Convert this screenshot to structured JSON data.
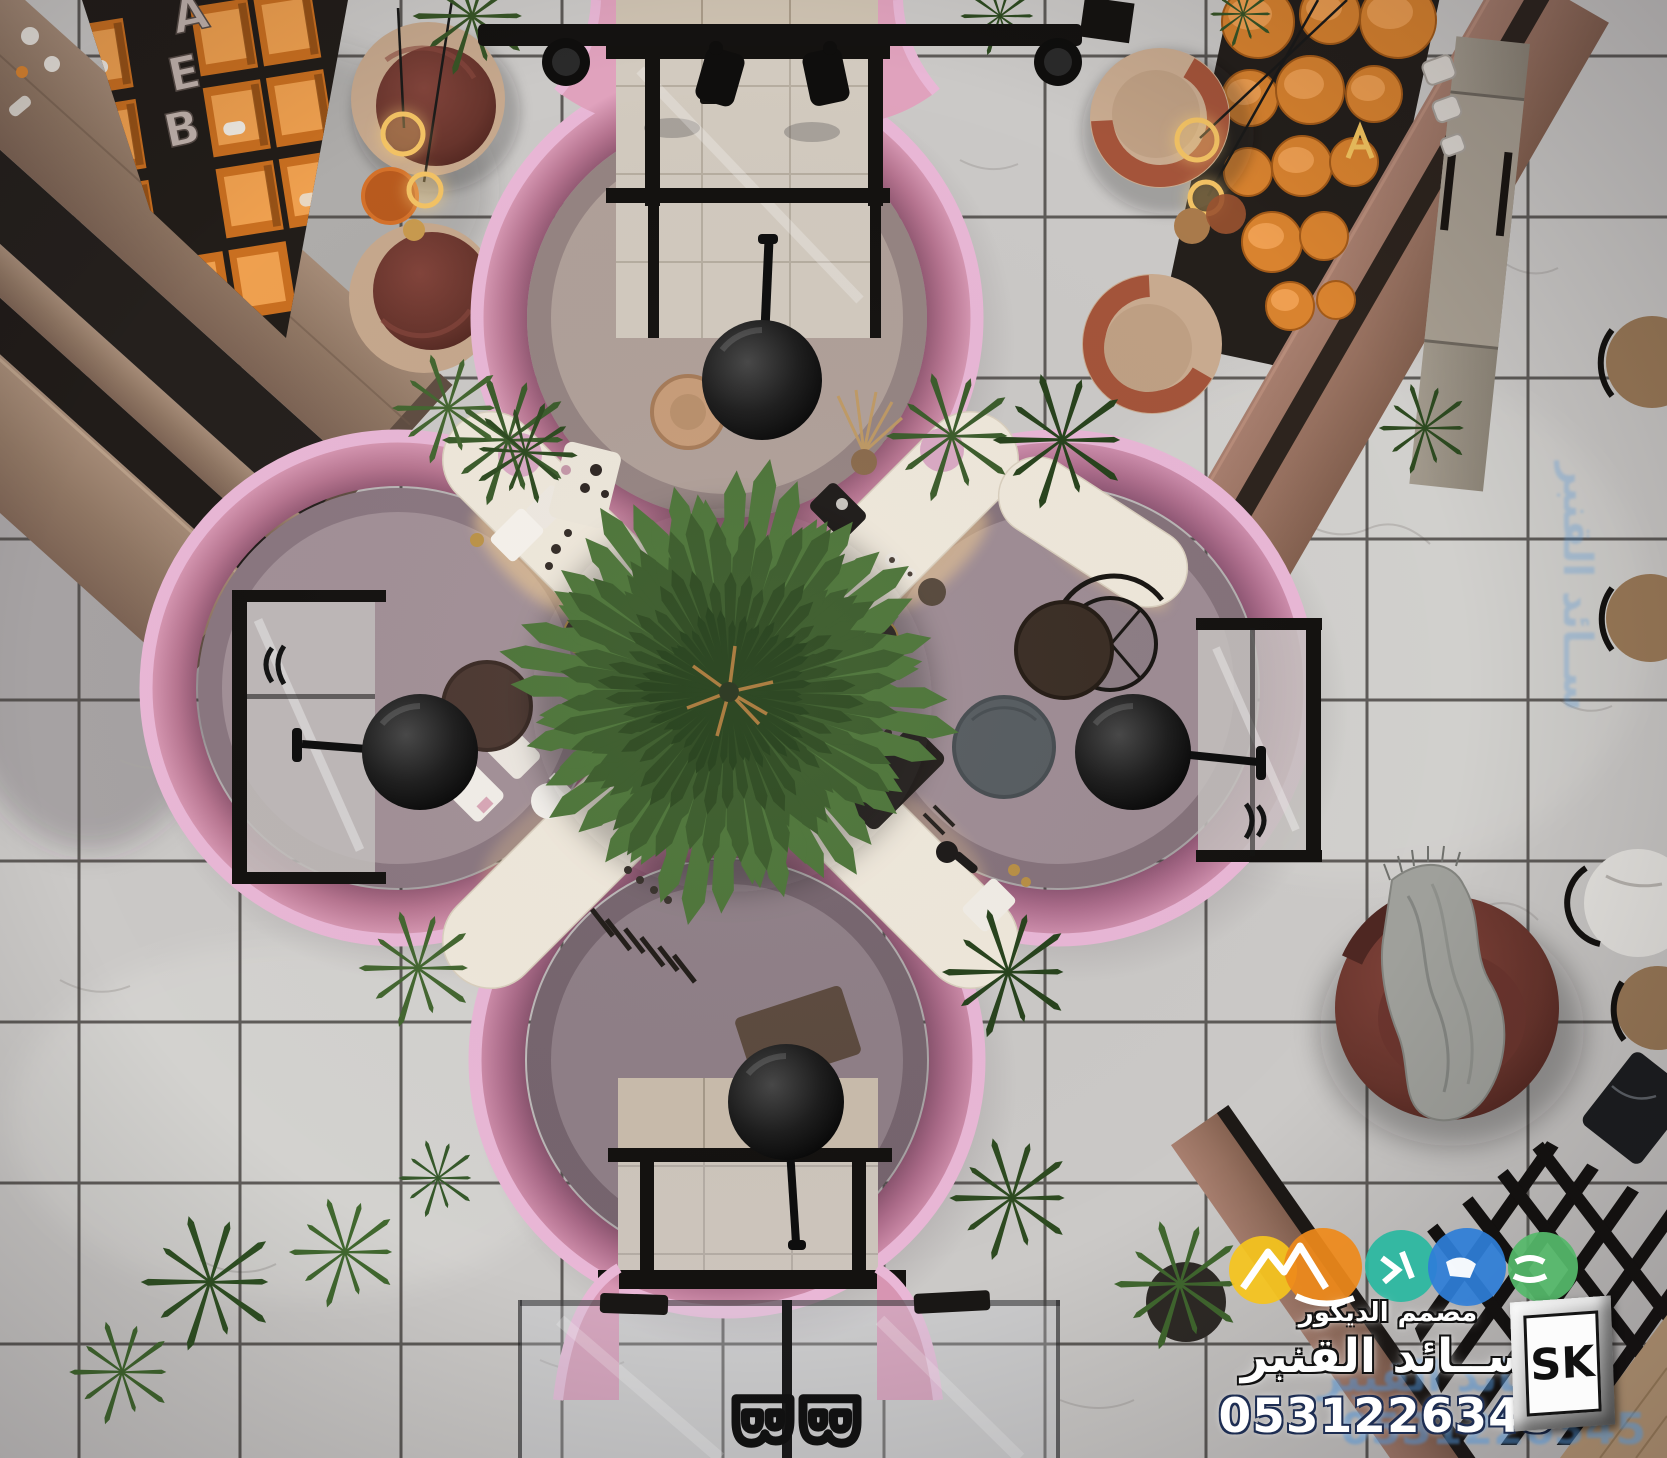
{
  "scene": {
    "type": "3d-interior-render-top-view",
    "subject": "Top-down 3D render of a beauty salon: four pink circular pods around a central fan palm on marble tile, wooden display counters with orange shelving, lounge armchairs and glass entrances",
    "wall_letters": [
      "B",
      "E",
      "A"
    ],
    "door_handle_letter": "B"
  },
  "watermark": {
    "logo_circle_colors": [
      "#f5c41d",
      "#ee8a1b",
      "#2ab8a0",
      "#2e7ed7",
      "#55b96a"
    ],
    "tagline": "مصمم الديكور",
    "designer_name": "ســائد القنبر",
    "phone": "0531226345",
    "badge": "SK"
  },
  "palette": {
    "floor_marble": "#cbc9c7",
    "tile_grout": "#3f3b38",
    "pod_trim_pink": "#e9b7d6",
    "pod_wall_rose": "#c27f9d",
    "pod_floor_mauve": "#9e8c94",
    "counter_cream": "#efe8db",
    "wood": "#97806f",
    "dark_wall": "#241f1b",
    "shelf_orange": "#dd8631",
    "armchair_maroon": "#6e3a31",
    "armchair_tan": "#c6a88d",
    "palm_green": "#3b5c2b",
    "lamp_gold": "#e8b75a",
    "frame_black": "#16130f"
  }
}
